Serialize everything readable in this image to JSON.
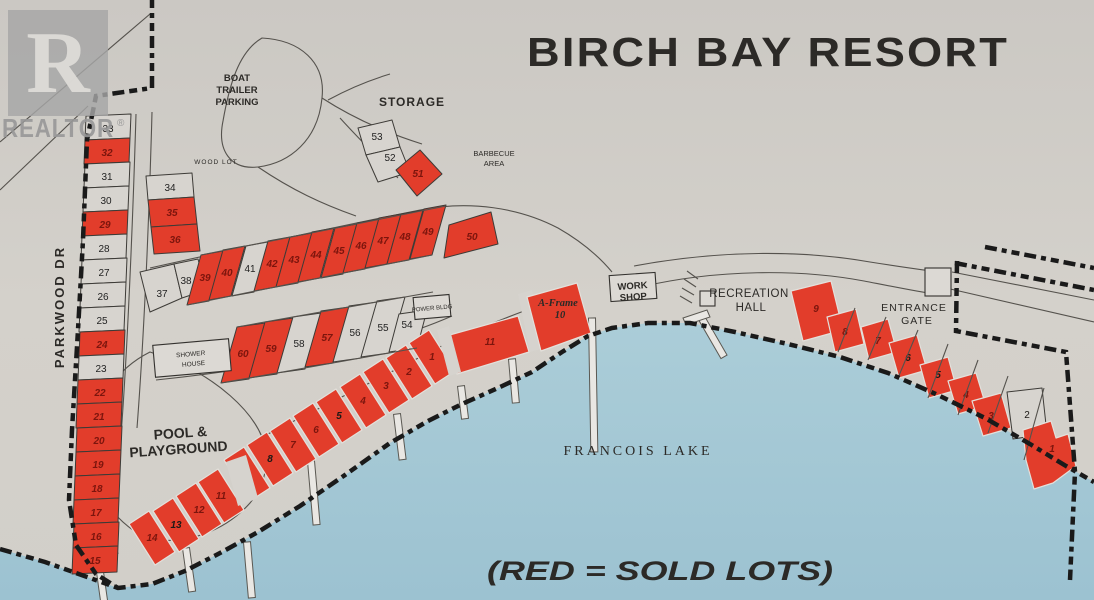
{
  "title": "BIRCH BAY RESORT",
  "legend": "(RED = SOLD LOTS)",
  "logo": {
    "letter": "R",
    "brand": "REALTOR",
    "registered": "®"
  },
  "labels": {
    "boat_trailer_parking": {
      "l1": "BOAT",
      "l2": "TRAILER",
      "l3": "PARKING"
    },
    "storage": "STORAGE",
    "wood_lot": "WOOD LOT",
    "barbecue_area": {
      "l1": "BARBECUE",
      "l2": "AREA"
    },
    "parkwood_dr": "PARKWOOD DR",
    "shower_house": {
      "l1": "SHOWER",
      "l2": "HOUSE"
    },
    "pool_playground": {
      "l1": "POOL &",
      "l2": "PLAYGROUND"
    },
    "power_bldg": "POWER BLDG",
    "work_shop": {
      "l1": "WORK",
      "l2": "SHOP"
    },
    "recreation_hall": {
      "l1": "RECREATION",
      "l2": "HALL"
    },
    "entrance_gate": {
      "l1": "ENTRANCE",
      "l2": "GATE"
    },
    "a_frame": {
      "l1": "A-Frame",
      "l2": "10"
    },
    "lake": "FRANCOIS  LAKE"
  },
  "colors": {
    "sold_red": "#e23d2b",
    "water_blue": "#a6c9d5",
    "paper": "#d2cfc9",
    "boundary_black": "#1a1a1a"
  },
  "lots": [
    {
      "id": "p33",
      "n": "33",
      "sold": false
    },
    {
      "id": "p32",
      "n": "32",
      "sold": true
    },
    {
      "id": "p31",
      "n": "31",
      "sold": false
    },
    {
      "id": "p30",
      "n": "30",
      "sold": false
    },
    {
      "id": "p29",
      "n": "29",
      "sold": true
    },
    {
      "id": "p28",
      "n": "28",
      "sold": false
    },
    {
      "id": "p27",
      "n": "27",
      "sold": false
    },
    {
      "id": "p26",
      "n": "26",
      "sold": false
    },
    {
      "id": "p25",
      "n": "25",
      "sold": false
    },
    {
      "id": "p24",
      "n": "24",
      "sold": true
    },
    {
      "id": "p23",
      "n": "23",
      "sold": false
    },
    {
      "id": "p22",
      "n": "22",
      "sold": true
    },
    {
      "id": "p21",
      "n": "21",
      "sold": true
    },
    {
      "id": "p20",
      "n": "20",
      "sold": true
    },
    {
      "id": "p19",
      "n": "19",
      "sold": true
    },
    {
      "id": "p18",
      "n": "18",
      "sold": true
    },
    {
      "id": "p17",
      "n": "17",
      "sold": true
    },
    {
      "id": "p16",
      "n": "16",
      "sold": true
    },
    {
      "id": "p15",
      "n": "15",
      "sold": true
    },
    {
      "id": "p34",
      "n": "34",
      "sold": false
    },
    {
      "id": "p35",
      "n": "35",
      "sold": true
    },
    {
      "id": "p36",
      "n": "36",
      "sold": true
    },
    {
      "id": "p37",
      "n": "37",
      "sold": false
    },
    {
      "id": "p38",
      "n": "38",
      "sold": false
    },
    {
      "id": "p39",
      "n": "39",
      "sold": true
    },
    {
      "id": "p40",
      "n": "40",
      "sold": true
    },
    {
      "id": "p41",
      "n": "41",
      "sold": false
    },
    {
      "id": "p42",
      "n": "42",
      "sold": true
    },
    {
      "id": "p43",
      "n": "43",
      "sold": true
    },
    {
      "id": "p44",
      "n": "44",
      "sold": true
    },
    {
      "id": "p45",
      "n": "45",
      "sold": true
    },
    {
      "id": "p46",
      "n": "46",
      "sold": true
    },
    {
      "id": "p47",
      "n": "47",
      "sold": true
    },
    {
      "id": "p48",
      "n": "48",
      "sold": true
    },
    {
      "id": "p49",
      "n": "49",
      "sold": true
    },
    {
      "id": "p50",
      "n": "50",
      "sold": true
    },
    {
      "id": "p53",
      "n": "53",
      "sold": false
    },
    {
      "id": "p52",
      "n": "52",
      "sold": false
    },
    {
      "id": "p51",
      "n": "51",
      "sold": true
    },
    {
      "id": "p60",
      "n": "60",
      "sold": true
    },
    {
      "id": "p59",
      "n": "59",
      "sold": true
    },
    {
      "id": "p58",
      "n": "58",
      "sold": false
    },
    {
      "id": "p57",
      "n": "57",
      "sold": true
    },
    {
      "id": "p56",
      "n": "56",
      "sold": false
    },
    {
      "id": "p55",
      "n": "55",
      "sold": false
    },
    {
      "id": "p54",
      "n": "54",
      "sold": false
    },
    {
      "id": "w14",
      "n": "14",
      "sold": true
    },
    {
      "id": "w13",
      "n": "13",
      "sold": true
    },
    {
      "id": "w12",
      "n": "12",
      "sold": true
    },
    {
      "id": "w11",
      "n": "11",
      "sold": true
    },
    {
      "id": "w9",
      "n": "9",
      "sold": true
    },
    {
      "id": "w8",
      "n": "8",
      "sold": true
    },
    {
      "id": "w7",
      "n": "7",
      "sold": true
    },
    {
      "id": "w6",
      "n": "6",
      "sold": true
    },
    {
      "id": "w5",
      "n": "5",
      "sold": true
    },
    {
      "id": "w4",
      "n": "4",
      "sold": true
    },
    {
      "id": "w3",
      "n": "3",
      "sold": true
    },
    {
      "id": "w2",
      "n": "2",
      "sold": true
    },
    {
      "id": "w1",
      "n": "1",
      "sold": true
    },
    {
      "id": "w11b",
      "n": "11",
      "sold": true
    },
    {
      "id": "r9",
      "n": "9",
      "sold": true
    },
    {
      "id": "r8",
      "n": "8",
      "sold": true
    },
    {
      "id": "r7",
      "n": "7",
      "sold": true
    },
    {
      "id": "r6",
      "n": "6",
      "sold": true
    },
    {
      "id": "r5",
      "n": "5",
      "sold": true
    },
    {
      "id": "r4",
      "n": "4",
      "sold": true
    },
    {
      "id": "r3",
      "n": "3",
      "sold": true
    },
    {
      "id": "r2",
      "n": "2",
      "sold": false
    },
    {
      "id": "r1",
      "n": "1",
      "sold": true
    }
  ]
}
